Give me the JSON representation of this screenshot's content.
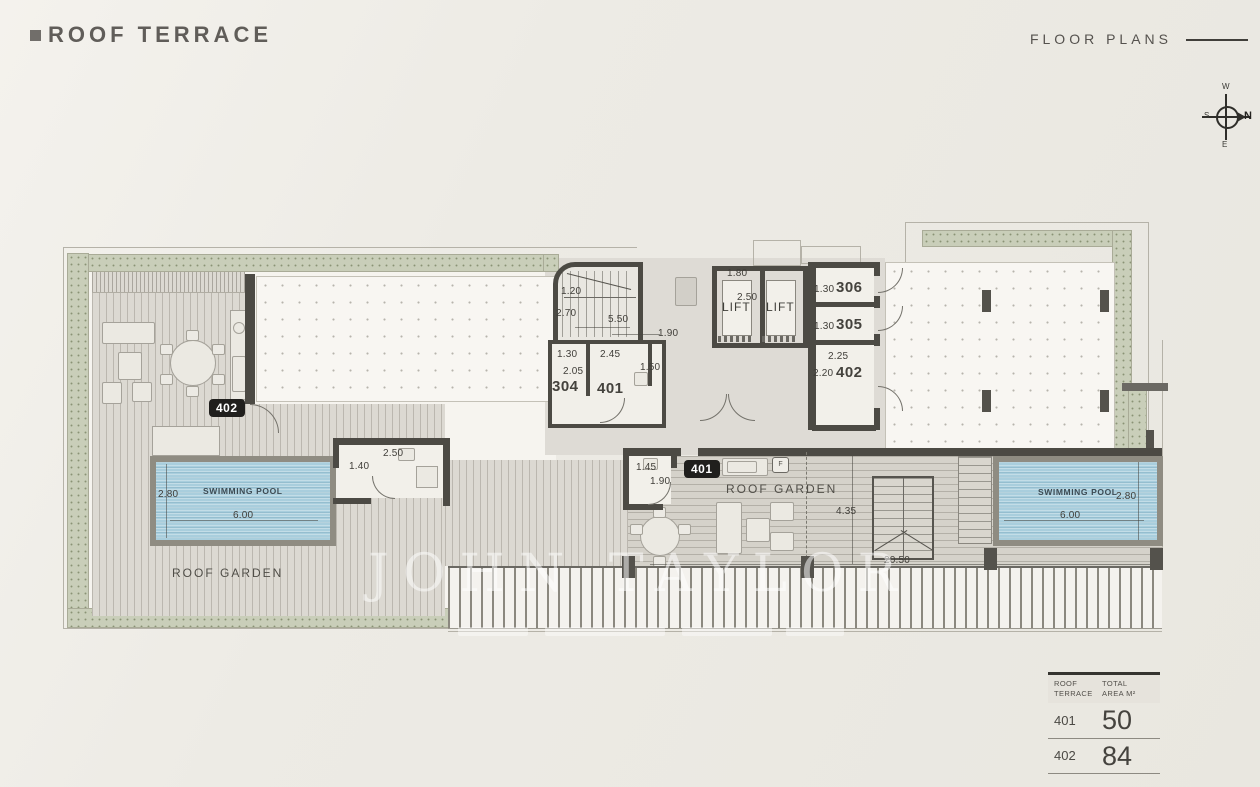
{
  "header": {
    "title": "ROOF TERRACE",
    "right_label": "FLOOR PLANS"
  },
  "compass": {
    "n": "N",
    "e": "E",
    "s": "S",
    "w": "W"
  },
  "watermark": {
    "text": "JOHN TAYLOR"
  },
  "plan": {
    "badges": {
      "left_unit": "402",
      "right_unit": "401"
    },
    "rooms": {
      "r304": "304",
      "r401": "401",
      "r306": "306",
      "r305": "305",
      "r402": "402",
      "lift": "LIFT"
    },
    "labels": {
      "roof_garden": "ROOF GARDEN",
      "swimming_pool": "SWIMMING POOL",
      "appliance": "F"
    },
    "dims": {
      "stair_w": "1.20",
      "stair_d": "2.70",
      "stair_run": "5.50",
      "landing": "1.90",
      "lift_w": "1.80",
      "lift_d": "2.50",
      "d304_w": "1.30",
      "corr_w": "2.45",
      "d304_d": "2.05",
      "d401_d": "1.50",
      "d306": "1.30",
      "d305": "1.30",
      "d402_w": "2.25",
      "d402_d": "2.20",
      "pool_w": "2.80",
      "pool_l": "6.00",
      "wcL_d": "1.40",
      "wcL_w": "2.50",
      "wcR_w": "1.45",
      "wcR_d": "1.90",
      "terr_d": "4.35",
      "terr_l": "20.50"
    }
  },
  "table": {
    "header": {
      "c1a": "ROOF",
      "c1b": "TERRACE",
      "c2a": "TOTAL",
      "c2b": "AREA M²"
    },
    "rows": [
      {
        "unit": "401",
        "area": "50"
      },
      {
        "unit": "402",
        "area": "84"
      }
    ]
  }
}
